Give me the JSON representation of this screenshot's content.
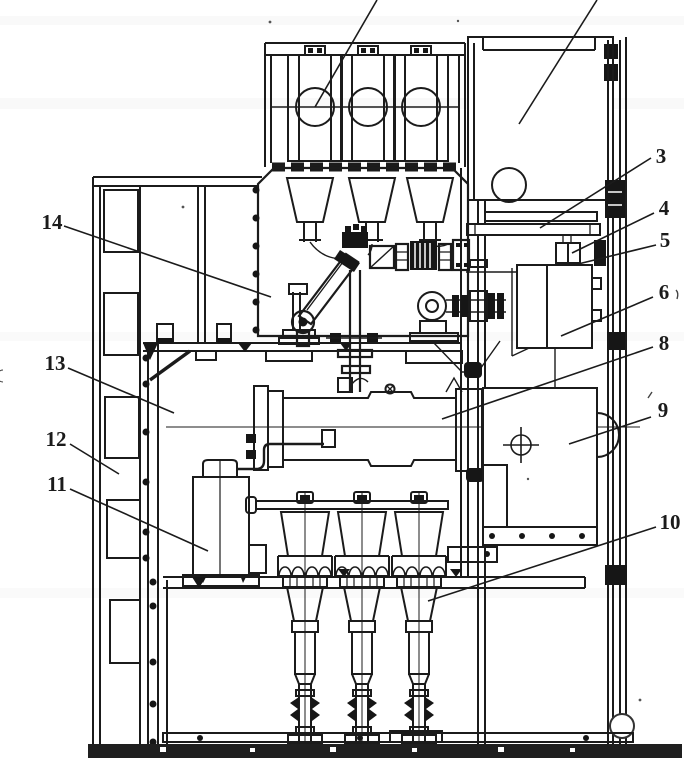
{
  "figure": {
    "colors": {
      "background": "#ffffff",
      "line": "#1b1b1b",
      "dark_fill": "#161616"
    },
    "callouts": {
      "c3": "3",
      "c4": "4",
      "c5": "5",
      "c6": "6",
      "c8": "8",
      "c9": "9",
      "c10": "10",
      "c11": "11",
      "c12": "12",
      "c13": "13",
      "c14": "14"
    }
  }
}
